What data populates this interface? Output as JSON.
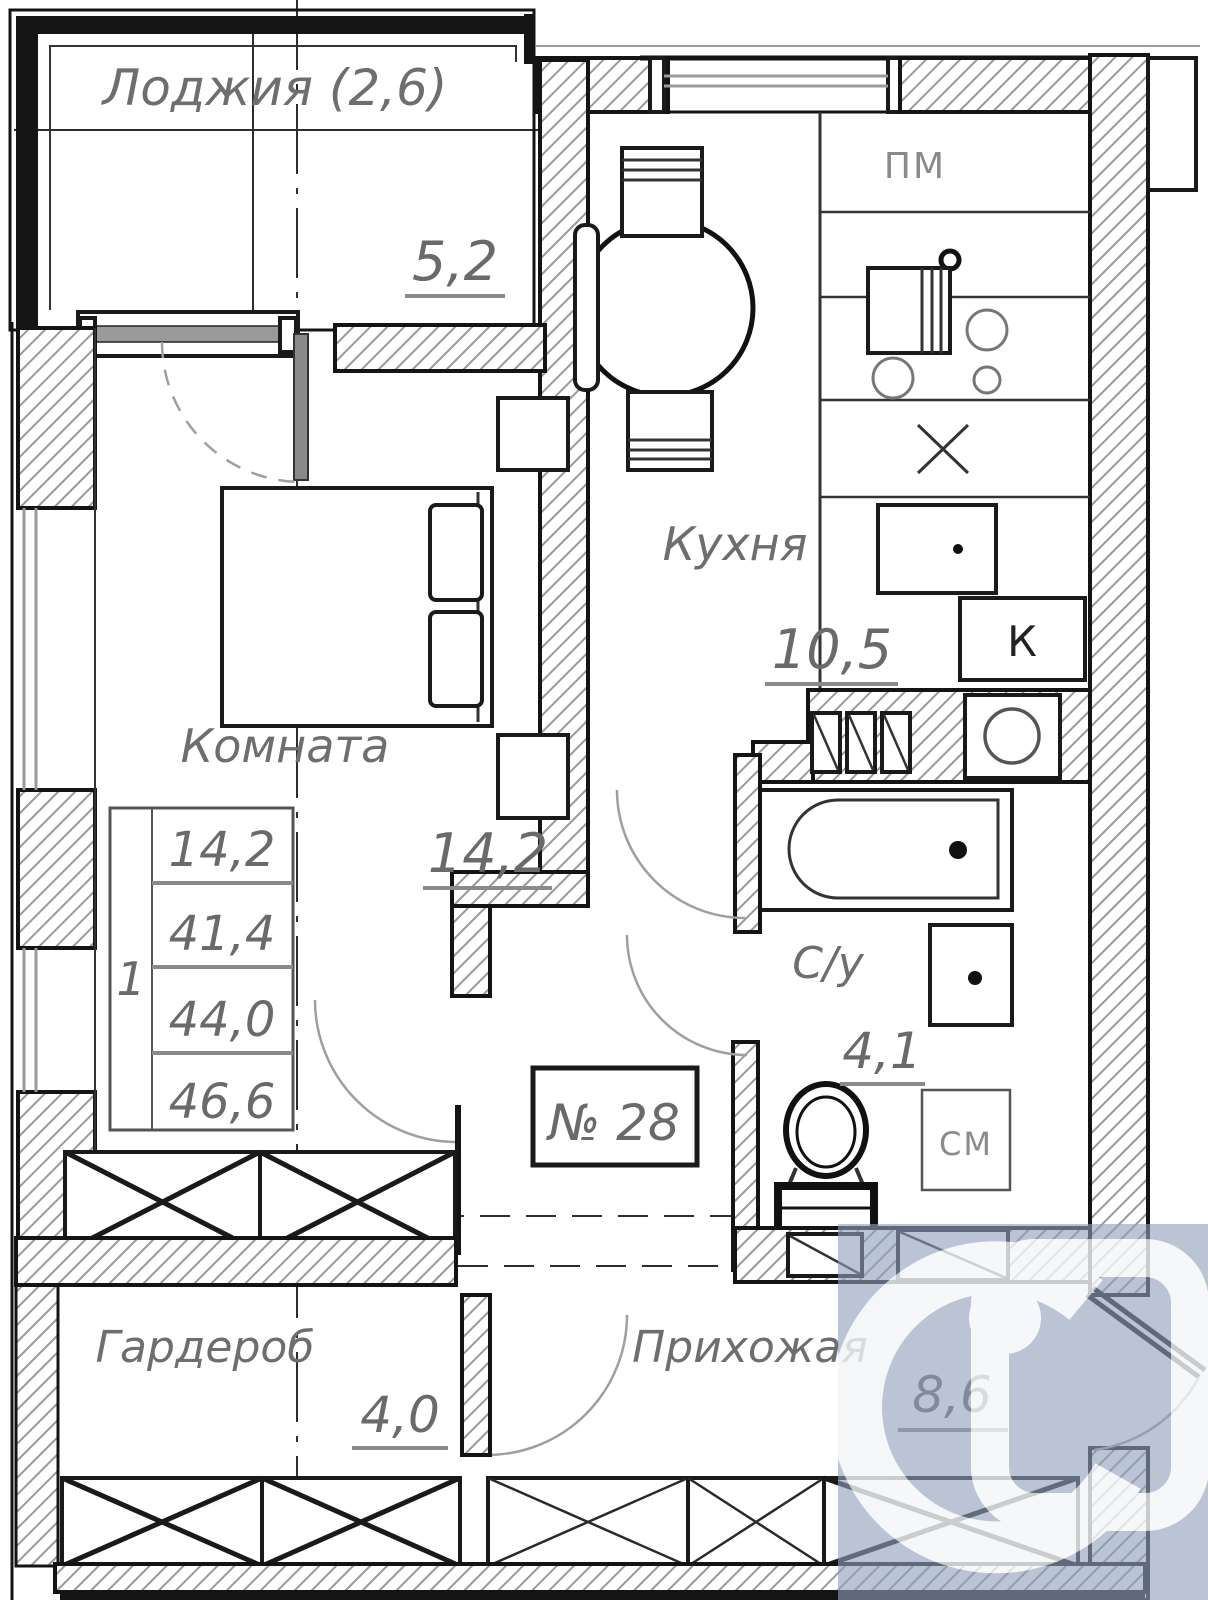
{
  "rooms": {
    "loggia": {
      "name": "Лоджия (2,6)",
      "area": "5,2"
    },
    "kitchen": {
      "name": "Кухня",
      "area": "10,5"
    },
    "living": {
      "name": "Комната",
      "area": "14,2"
    },
    "bathroom": {
      "name": "С/у",
      "area": "4,1"
    },
    "wardrobe": {
      "name": "Гардероб",
      "area": "4,0"
    },
    "hallway": {
      "name": "Прихожая",
      "area": "8,6"
    }
  },
  "area_table": {
    "index": "1",
    "rows": [
      "14,2",
      "41,4",
      "44,0",
      "46,6"
    ]
  },
  "apartment": {
    "number": "№ 28"
  },
  "appliance_labels": {
    "dishwasher": "ПМ",
    "boiler": "К",
    "washer": "СМ"
  },
  "colors": {
    "wall_line": "#141414",
    "text_gray": "#6e6e6e",
    "watermark_overlay": "#8fa0bb",
    "watermark_logo": "#ffffff"
  }
}
